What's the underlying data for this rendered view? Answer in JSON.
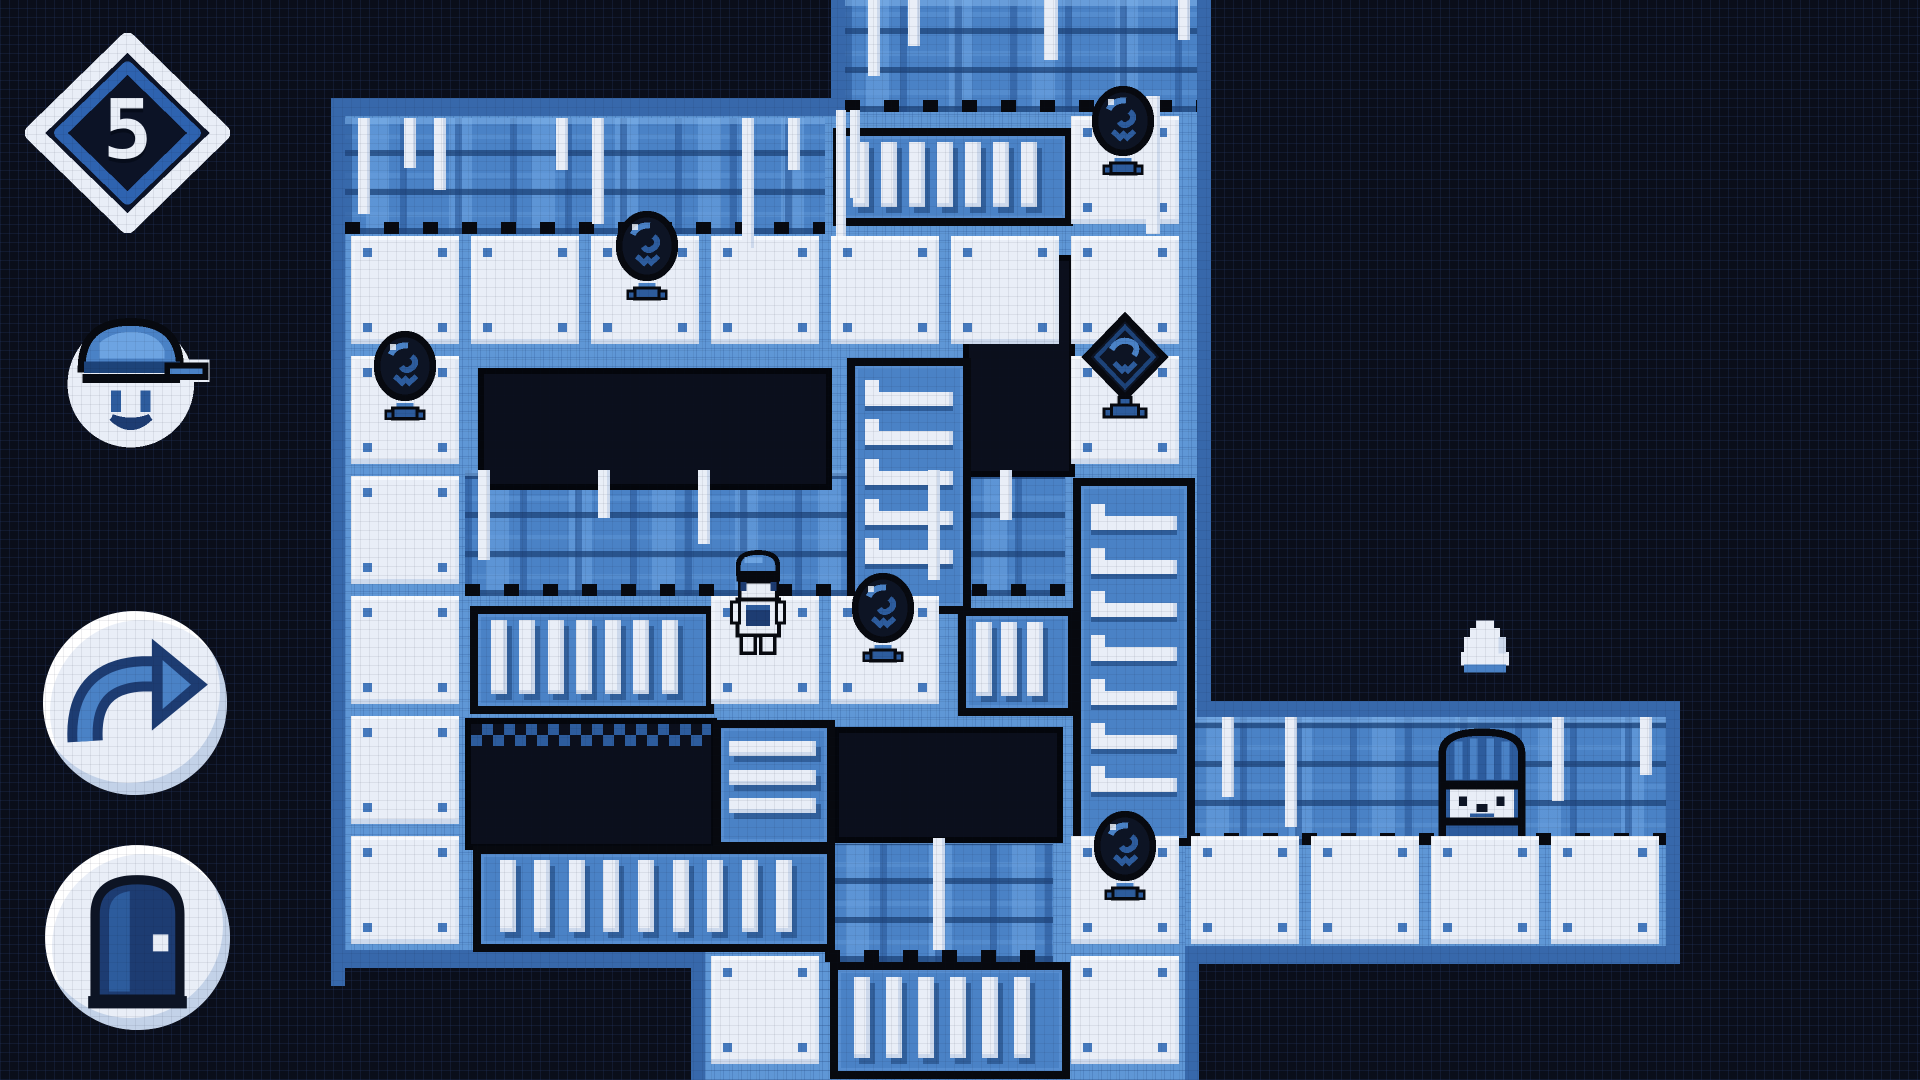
{
  "screen": {
    "width": 1920,
    "height": 1080
  },
  "palette": {
    "void": "#0a0e1a",
    "ink": "#07090f",
    "ink2": "#0d1424",
    "border": "#3768ab",
    "underlay": "#5f97d6",
    "wall_base": "#4a82c6",
    "wall_dark": "#2d5c9d",
    "wall_deep": "#1d4379",
    "wall_light": "#6da4e2",
    "tile": "#e9eef7",
    "tile_shade": "#cdd9ec",
    "dot": "#4579bd",
    "accent": "#4a82c6",
    "accent_mid": "#2d5c9d",
    "bar": "#e9eef7",
    "pit": "#0b0f1c",
    "pit_border": "#04060c",
    "badge_fill": "#0c1326",
    "badge_ring": "#2e63b0",
    "icon_navy": "#1d3c72"
  },
  "hud": {
    "level_badge": {
      "name": "level-badge",
      "icon": "diamond-badge-icon",
      "value": "5",
      "box": [
        25,
        33,
        205,
        200
      ]
    },
    "portrait": {
      "name": "player-portrait",
      "icon": "capped-character-face-icon",
      "box": [
        58,
        296,
        156,
        166
      ]
    },
    "undo_button": {
      "name": "undo-button",
      "icon": "redo-arrow-icon",
      "box": [
        43,
        611,
        184,
        184
      ]
    },
    "exit_button": {
      "name": "exit-button",
      "icon": "door-icon",
      "box": [
        45,
        845,
        185,
        185
      ]
    }
  },
  "map": {
    "tile_size": 120,
    "origin": {
      "x": 345,
      "y": -10
    },
    "underlay": [
      [
        345,
        110,
        852,
        842
      ],
      [
        845,
        0,
        352,
        110
      ],
      [
        1185,
        717,
        481,
        231
      ],
      [
        705,
        950,
        480,
        130
      ]
    ],
    "borders": [
      [
        331,
        98,
        14,
        888
      ],
      [
        331,
        98,
        514,
        18
      ],
      [
        831,
        0,
        14,
        100
      ],
      [
        1197,
        0,
        14,
        715
      ],
      [
        1197,
        701,
        469,
        16
      ],
      [
        1666,
        701,
        14,
        263
      ],
      [
        1185,
        946,
        495,
        18
      ],
      [
        331,
        950,
        374,
        18
      ],
      [
        691,
        950,
        14,
        130
      ],
      [
        1185,
        964,
        14,
        116
      ]
    ],
    "walls": [
      {
        "rect": [
          345,
          118,
          480,
          116
        ]
      },
      {
        "rect": [
          845,
          0,
          352,
          112
        ]
      },
      {
        "rect": [
          465,
          470,
          600,
          126
        ]
      },
      {
        "rect": [
          825,
          838,
          228,
          124
        ]
      },
      {
        "rect": [
          1185,
          717,
          481,
          128
        ]
      }
    ],
    "drips": [
      [
        358,
        118,
        12,
        96
      ],
      [
        404,
        118,
        12,
        50
      ],
      [
        434,
        118,
        12,
        72
      ],
      [
        556,
        118,
        12,
        52
      ],
      [
        592,
        118,
        12,
        106
      ],
      [
        742,
        118,
        12,
        130
      ],
      [
        788,
        118,
        12,
        52
      ],
      [
        836,
        110,
        10,
        126
      ],
      [
        850,
        110,
        10,
        88
      ],
      [
        868,
        0,
        12,
        76
      ],
      [
        908,
        0,
        12,
        46
      ],
      [
        1044,
        0,
        14,
        60
      ],
      [
        1146,
        96,
        14,
        138
      ],
      [
        1178,
        0,
        12,
        40
      ],
      [
        478,
        470,
        12,
        90
      ],
      [
        598,
        470,
        12,
        48
      ],
      [
        698,
        470,
        12,
        74
      ],
      [
        928,
        470,
        12,
        110
      ],
      [
        1000,
        470,
        12,
        50
      ],
      [
        933,
        838,
        12,
        112
      ],
      [
        1222,
        717,
        12,
        80
      ],
      [
        1285,
        717,
        12,
        110
      ],
      [
        1552,
        717,
        12,
        84
      ],
      [
        1640,
        717,
        12,
        58
      ]
    ],
    "floor_tiles": [
      [
        0,
        2
      ],
      [
        0,
        3
      ],
      [
        0,
        4
      ],
      [
        0,
        5
      ],
      [
        0,
        6
      ],
      [
        0,
        7
      ],
      [
        1,
        2
      ],
      [
        2,
        2
      ],
      [
        3,
        2
      ],
      [
        4,
        2
      ],
      [
        5,
        2
      ],
      [
        3,
        5
      ],
      [
        4,
        5
      ],
      [
        6,
        1
      ],
      [
        6,
        2
      ],
      [
        6,
        3
      ],
      [
        6,
        7
      ],
      [
        6,
        8
      ],
      [
        3,
        8
      ],
      [
        7,
        7
      ],
      [
        8,
        7
      ],
      [
        9,
        7
      ],
      [
        10,
        7
      ]
    ],
    "pits": [
      {
        "rect": [
          478,
          368,
          342,
          110
        ],
        "checker": false
      },
      {
        "rect": [
          963,
          255,
          100,
          210
        ],
        "checker": false
      },
      {
        "rect": [
          465,
          718,
          240,
          120
        ],
        "checker": true
      },
      {
        "rect": [
          833,
          727,
          218,
          104
        ],
        "checker": false
      }
    ],
    "grates": [
      {
        "rect": [
          833,
          128,
          224,
          82
        ],
        "orientation": "v",
        "bars": 7
      },
      {
        "rect": [
          470,
          606,
          228,
          92
        ],
        "orientation": "v",
        "bars": 7
      },
      {
        "rect": [
          958,
          608,
          102,
          92
        ],
        "orientation": "v",
        "bars": 3
      },
      {
        "rect": [
          713,
          720,
          106,
          114
        ],
        "orientation": "h",
        "bars": 3
      },
      {
        "rect": [
          473,
          846,
          346,
          90
        ],
        "orientation": "v",
        "bars": 9
      },
      {
        "rect": [
          830,
          962,
          224,
          101
        ],
        "orientation": "v",
        "bars": 6
      }
    ],
    "ladders": [
      {
        "rect": [
          847,
          358,
          108,
          240
        ],
        "rungs": 5
      },
      {
        "rect": [
          1073,
          478,
          106,
          352
        ],
        "rungs": 7
      }
    ],
    "sprites": [
      {
        "type": "bomb",
        "name": "bomb-sprite",
        "box": [
          614,
          210,
          66,
          96
        ]
      },
      {
        "type": "bomb",
        "name": "bomb-sprite",
        "box": [
          372,
          330,
          66,
          96
        ]
      },
      {
        "type": "bomb",
        "name": "bomb-sprite",
        "box": [
          850,
          572,
          66,
          96
        ]
      },
      {
        "type": "bomb",
        "name": "bomb-sprite",
        "box": [
          1092,
          810,
          66,
          96
        ]
      },
      {
        "type": "bomb",
        "name": "bomb-sprite",
        "box": [
          1090,
          85,
          66,
          96
        ]
      },
      {
        "type": "diamond-bomb",
        "name": "diamond-bomb-sprite",
        "box": [
          1080,
          312,
          90,
          120
        ]
      },
      {
        "type": "player",
        "name": "player-character",
        "box": [
          723,
          548,
          70,
          120
        ]
      },
      {
        "type": "door",
        "name": "exit-door",
        "box": [
          1430,
          723,
          104,
          116
        ]
      },
      {
        "type": "ghost",
        "name": "ghost-blob",
        "box": [
          1452,
          616,
          66,
          60
        ]
      }
    ]
  }
}
